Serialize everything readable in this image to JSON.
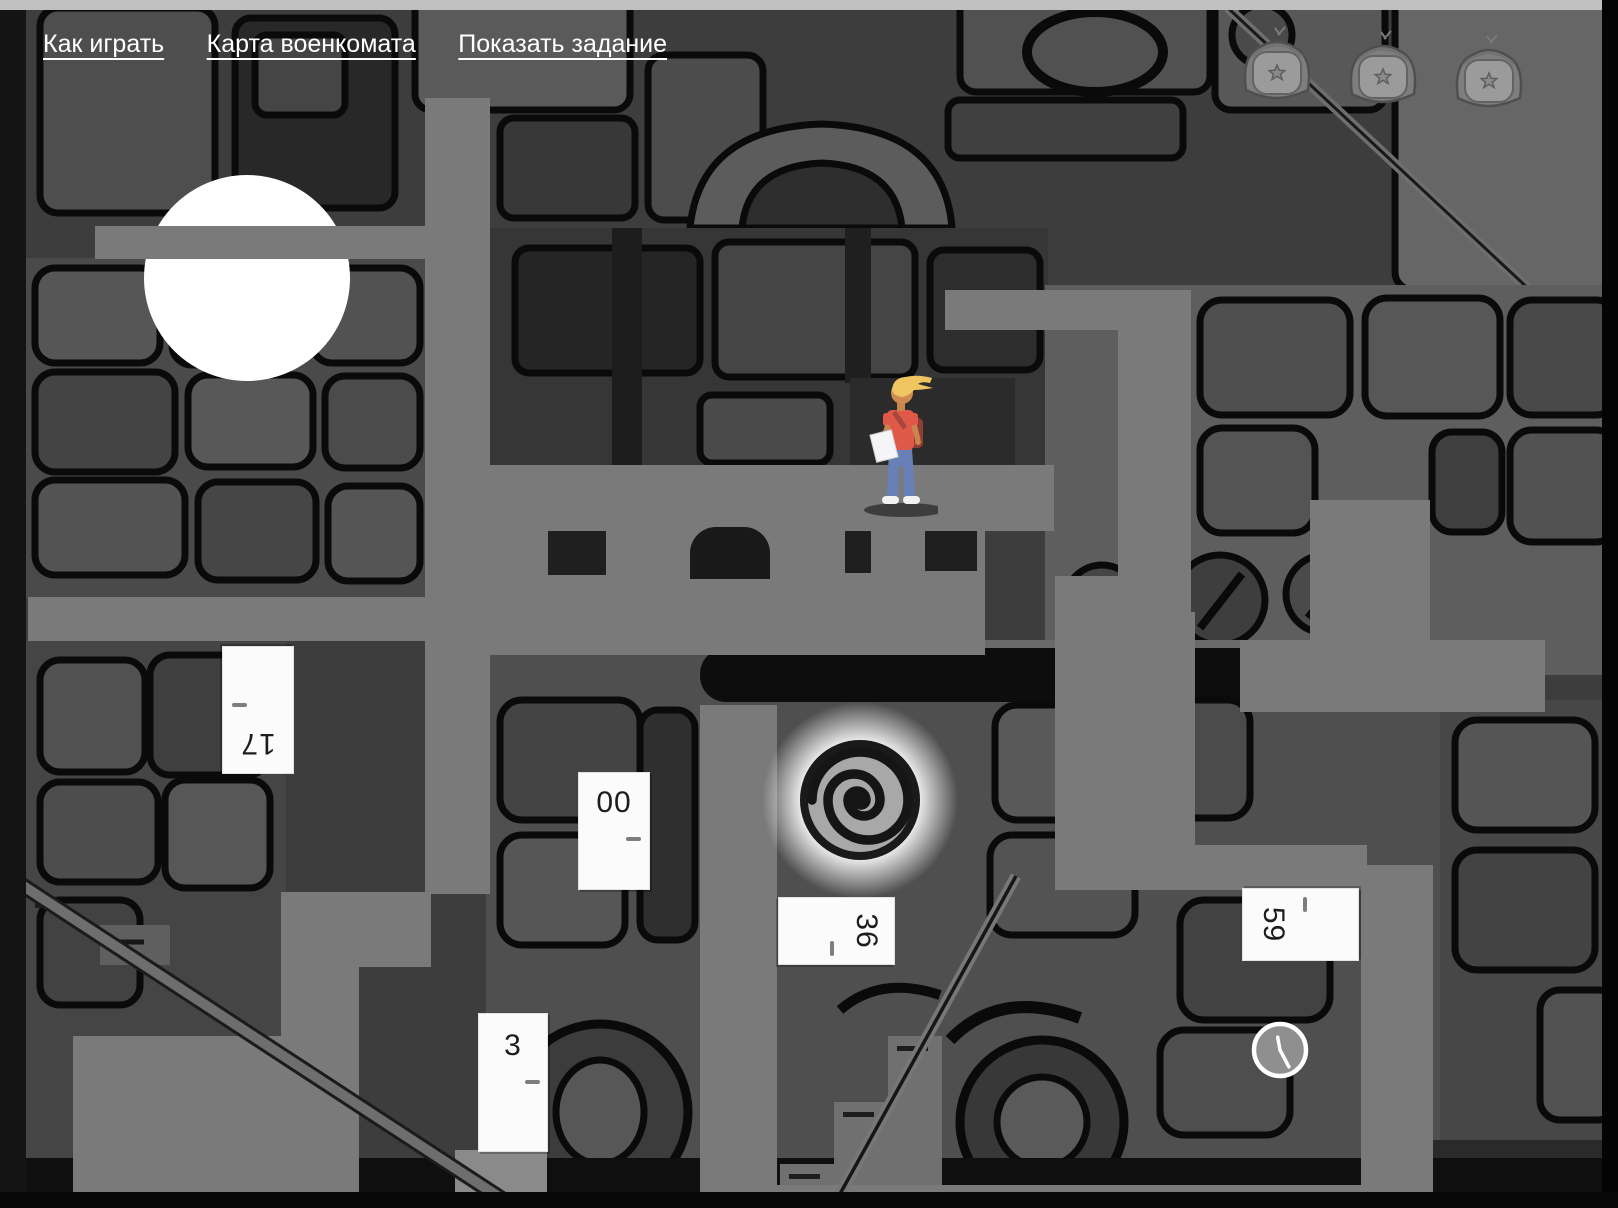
{
  "menu": {
    "items": [
      {
        "label": "Как играть"
      },
      {
        "label": "Карта военкомата"
      },
      {
        "label": "Показать задание"
      }
    ]
  },
  "badges": {
    "count": 3,
    "items": [
      {
        "name": "hat-star-badge",
        "state": "inactive"
      },
      {
        "name": "hat-star-badge",
        "state": "inactive"
      },
      {
        "name": "hat-star-badge",
        "state": "inactive"
      }
    ]
  },
  "doors": [
    {
      "number": "17",
      "orientation": "upside-down"
    },
    {
      "number": "00",
      "orientation": "upright"
    },
    {
      "number": "36",
      "orientation": "rotated-cw"
    },
    {
      "number": "3",
      "orientation": "upright"
    },
    {
      "number": "59",
      "orientation": "rotated-ccw"
    }
  ],
  "colors": {
    "path_gray": "#7a7a7a",
    "background": "#3d3d3d",
    "door_white": "#fbfbfb",
    "moon_white": "#ffffff",
    "shirt_red": "#e05848",
    "jeans_blue": "#6781b8",
    "hair_blonde": "#eec561",
    "skin": "#cd8b50"
  }
}
